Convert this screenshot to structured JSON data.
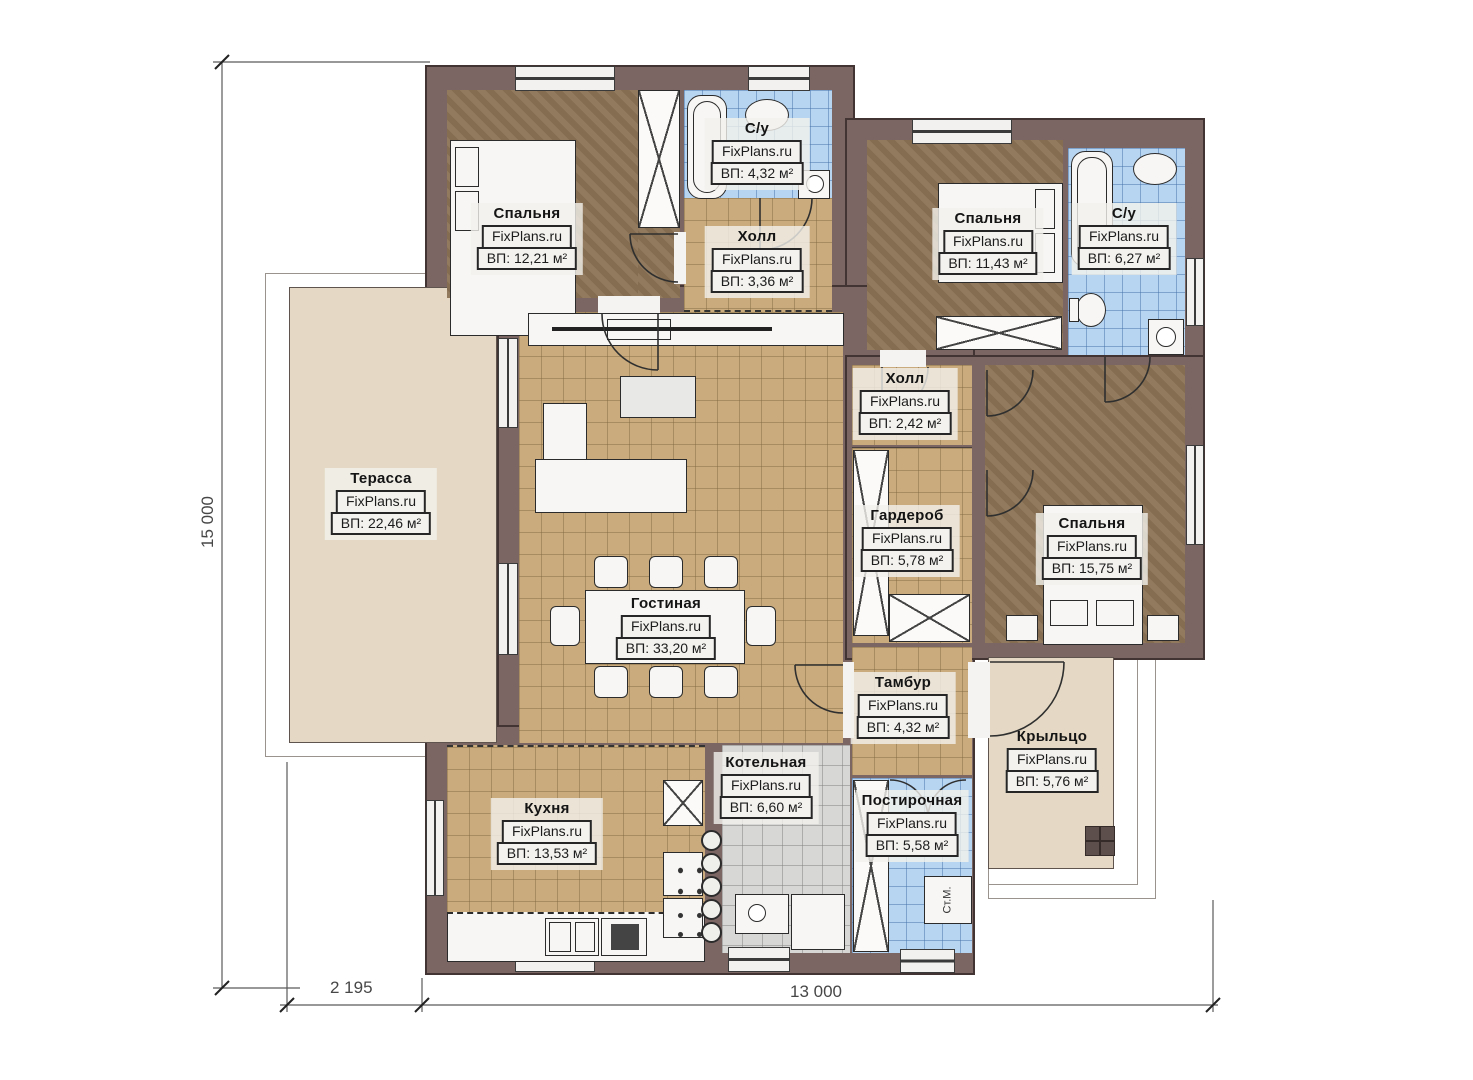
{
  "watermark": "FixPlans.ru",
  "rooms": [
    {
      "name": "Спальня",
      "area": "ВП: 12,21 м²"
    },
    {
      "name": "С/у",
      "area": "ВП: 4,32 м²"
    },
    {
      "name": "Холл",
      "area": "ВП: 3,36 м²"
    },
    {
      "name": "Спальня",
      "area": "ВП: 11,43 м²"
    },
    {
      "name": "С/у",
      "area": "ВП: 6,27 м²"
    },
    {
      "name": "Холл",
      "area": "ВП: 2,42 м²"
    },
    {
      "name": "Терасса",
      "area": "ВП: 22,46 м²"
    },
    {
      "name": "Гардероб",
      "area": "ВП: 5,78 м²"
    },
    {
      "name": "Спальня",
      "area": "ВП: 15,75 м²"
    },
    {
      "name": "Гостиная",
      "area": "ВП: 33,20 м²"
    },
    {
      "name": "Тамбур",
      "area": "ВП: 4,32 м²"
    },
    {
      "name": "Крыльцо",
      "area": "ВП: 5,76 м²"
    },
    {
      "name": "Кухня",
      "area": "ВП: 13,53 м²"
    },
    {
      "name": "Котельная",
      "area": "ВП: 6,60 м²"
    },
    {
      "name": "Постирочная",
      "area": "ВП: 5,58 м²"
    }
  ],
  "appliances": {
    "washing_machine": "Ст.М."
  },
  "dimensions": {
    "height": "15 000",
    "terrace_width": "2 195",
    "house_width": "13 000"
  },
  "colors": {
    "wall": "#7b6664",
    "floor_tile_tan": "#c9ab7d",
    "floor_tile_blue": "#b7d4f1",
    "floor_bedroom": "#8b7355",
    "floor_boiler": "#d7d7d5",
    "terrace": "#e5d9c5"
  }
}
